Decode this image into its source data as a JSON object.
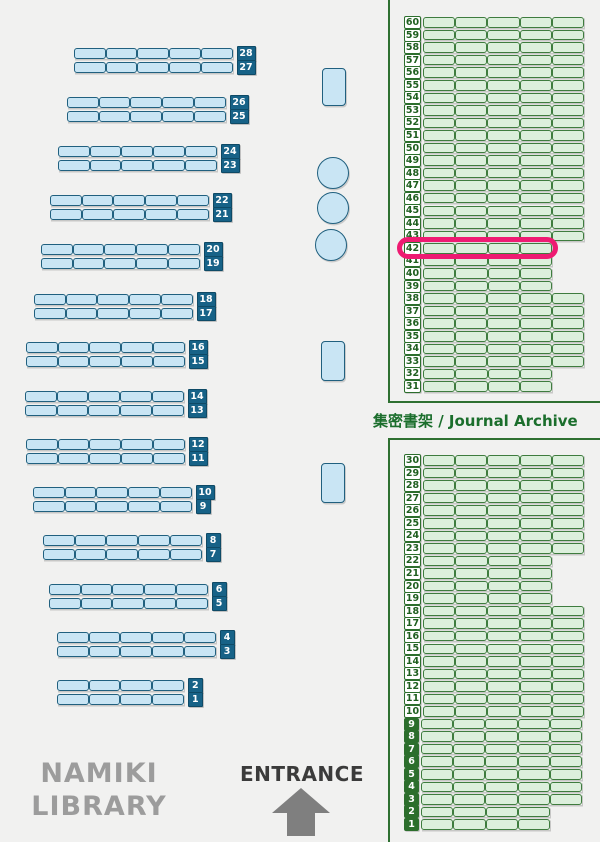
{
  "map_title": "NAMIKI LIBRARY floor map",
  "colors": {
    "background": "#f1f1f0",
    "blue_fill": "#c9e5f4",
    "blue_border": "#20607f",
    "blue_label_bg": "#176287",
    "green_fill": "#dcefdc",
    "green_border": "#3e7c3e",
    "green_dark": "#2c6e2c",
    "green_text": "#1f5f1f",
    "panel_border": "#2e7031",
    "section_label_green": "#1b6e2c",
    "highlight_pink": "#ee1b72",
    "library_name_gray": "#9c9c9c",
    "entrance_text": "#3b3b3b",
    "arrow_gray": "#7f7f7f"
  },
  "left_shelves": {
    "rows": [
      {
        "label": "28",
        "x": 74,
        "y": 48,
        "segments": 5
      },
      {
        "label": "27",
        "x": 74,
        "y": 62,
        "segments": 5
      },
      {
        "label": "26",
        "x": 67,
        "y": 97,
        "segments": 5
      },
      {
        "label": "25",
        "x": 67,
        "y": 111,
        "segments": 5
      },
      {
        "label": "24",
        "x": 58,
        "y": 146,
        "segments": 5
      },
      {
        "label": "23",
        "x": 58,
        "y": 160,
        "segments": 5
      },
      {
        "label": "22",
        "x": 50,
        "y": 195,
        "segments": 5
      },
      {
        "label": "21",
        "x": 50,
        "y": 209,
        "segments": 5
      },
      {
        "label": "20",
        "x": 41,
        "y": 244,
        "segments": 5
      },
      {
        "label": "19",
        "x": 41,
        "y": 258,
        "segments": 5
      },
      {
        "label": "18",
        "x": 34,
        "y": 294,
        "segments": 5
      },
      {
        "label": "17",
        "x": 34,
        "y": 308,
        "segments": 5
      },
      {
        "label": "16",
        "x": 26,
        "y": 342,
        "segments": 5
      },
      {
        "label": "15",
        "x": 26,
        "y": 356,
        "segments": 5
      },
      {
        "label": "14",
        "x": 25,
        "y": 391,
        "segments": 5
      },
      {
        "label": "13",
        "x": 25,
        "y": 405,
        "segments": 5
      },
      {
        "label": "12",
        "x": 26,
        "y": 439,
        "segments": 5
      },
      {
        "label": "11",
        "x": 26,
        "y": 453,
        "segments": 5
      },
      {
        "label": "10",
        "x": 33,
        "y": 487,
        "segments": 5
      },
      {
        "label": "9",
        "x": 33,
        "y": 501,
        "segments": 5
      },
      {
        "label": "8",
        "x": 43,
        "y": 535,
        "segments": 5
      },
      {
        "label": "7",
        "x": 43,
        "y": 549,
        "segments": 5
      },
      {
        "label": "6",
        "x": 49,
        "y": 584,
        "segments": 5
      },
      {
        "label": "5",
        "x": 49,
        "y": 598,
        "segments": 5
      },
      {
        "label": "4",
        "x": 57,
        "y": 632,
        "segments": 5
      },
      {
        "label": "3",
        "x": 57,
        "y": 646,
        "segments": 5
      },
      {
        "label": "2",
        "x": 57,
        "y": 680,
        "segments": 4
      },
      {
        "label": "1",
        "x": 57,
        "y": 694,
        "segments": 4
      }
    ]
  },
  "fixtures": [
    {
      "type": "rect",
      "x": 322,
      "y": 68,
      "w": 22,
      "h": 36
    },
    {
      "type": "circle",
      "cx": 332,
      "cy": 172,
      "r": 15
    },
    {
      "type": "circle",
      "cx": 332,
      "cy": 207,
      "r": 15
    },
    {
      "type": "circle",
      "cx": 330,
      "cy": 244,
      "r": 15
    },
    {
      "type": "rect",
      "x": 321,
      "y": 341,
      "w": 22,
      "h": 38
    },
    {
      "type": "rect",
      "x": 321,
      "y": 463,
      "w": 22,
      "h": 38
    }
  ],
  "archive": {
    "section_label": "集密書架 / Journal Archive",
    "highlighted_shelf": "42",
    "top_section": {
      "rows": [
        {
          "label": "60",
          "segments": 5
        },
        {
          "label": "59",
          "segments": 5
        },
        {
          "label": "58",
          "segments": 5
        },
        {
          "label": "57",
          "segments": 5
        },
        {
          "label": "56",
          "segments": 5
        },
        {
          "label": "55",
          "segments": 5
        },
        {
          "label": "54",
          "segments": 5
        },
        {
          "label": "53",
          "segments": 5
        },
        {
          "label": "52",
          "segments": 5
        },
        {
          "label": "51",
          "segments": 5
        },
        {
          "label": "50",
          "segments": 5
        },
        {
          "label": "49",
          "segments": 5
        },
        {
          "label": "48",
          "segments": 5
        },
        {
          "label": "47",
          "segments": 5
        },
        {
          "label": "46",
          "segments": 5
        },
        {
          "label": "45",
          "segments": 5
        },
        {
          "label": "44",
          "segments": 5
        },
        {
          "label": "43",
          "segments": 5
        },
        {
          "label": "42",
          "segments": 4
        },
        {
          "label": "41",
          "segments": 4
        },
        {
          "label": "40",
          "segments": 4
        },
        {
          "label": "39",
          "segments": 4
        },
        {
          "label": "38",
          "segments": 5
        },
        {
          "label": "37",
          "segments": 5
        },
        {
          "label": "36",
          "segments": 5
        },
        {
          "label": "35",
          "segments": 5
        },
        {
          "label": "34",
          "segments": 5
        },
        {
          "label": "33",
          "segments": 5
        },
        {
          "label": "32",
          "segments": 4
        },
        {
          "label": "31",
          "segments": 4
        }
      ]
    },
    "bottom_section": {
      "rows": [
        {
          "label": "30",
          "segments": 5
        },
        {
          "label": "29",
          "segments": 5
        },
        {
          "label": "28",
          "segments": 5
        },
        {
          "label": "27",
          "segments": 5
        },
        {
          "label": "26",
          "segments": 5
        },
        {
          "label": "25",
          "segments": 5
        },
        {
          "label": "24",
          "segments": 5
        },
        {
          "label": "23",
          "segments": 5
        },
        {
          "label": "22",
          "segments": 4
        },
        {
          "label": "21",
          "segments": 4
        },
        {
          "label": "20",
          "segments": 4
        },
        {
          "label": "19",
          "segments": 4
        },
        {
          "label": "18",
          "segments": 5
        },
        {
          "label": "17",
          "segments": 5
        },
        {
          "label": "16",
          "segments": 5
        },
        {
          "label": "15",
          "segments": 5
        },
        {
          "label": "14",
          "segments": 5
        },
        {
          "label": "13",
          "segments": 5
        },
        {
          "label": "12",
          "segments": 5
        },
        {
          "label": "11",
          "segments": 5
        },
        {
          "label": "10",
          "segments": 5
        },
        {
          "label": "9",
          "segments": 5
        },
        {
          "label": "8",
          "segments": 5
        },
        {
          "label": "7",
          "segments": 5
        },
        {
          "label": "6",
          "segments": 5
        },
        {
          "label": "5",
          "segments": 5
        },
        {
          "label": "4",
          "segments": 5
        },
        {
          "label": "3",
          "segments": 5
        },
        {
          "label": "2",
          "segments": 4
        },
        {
          "label": "1",
          "segments": 4
        }
      ]
    }
  },
  "footer": {
    "library_name_line1": "NAMIKI",
    "library_name_line2": "LIBRARY",
    "entrance_label": "ENTRANCE"
  }
}
